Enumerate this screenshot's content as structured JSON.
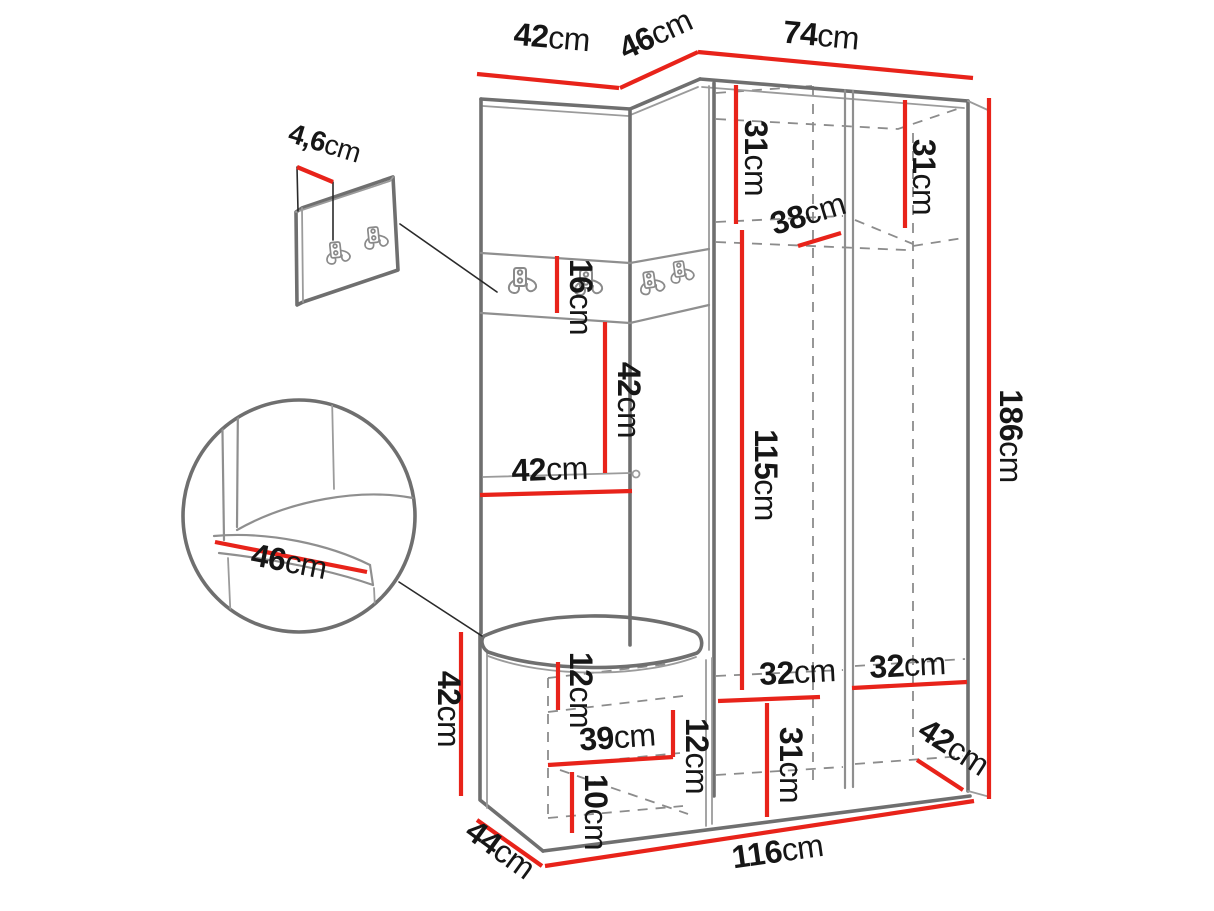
{
  "colors": {
    "dimension_line": "#e8231a",
    "structure_line": "#6f6f6f",
    "dashed_line": "#8c8c8c",
    "label_text": "#161616",
    "background": "#ffffff"
  },
  "dimensions": {
    "top_left_width": {
      "value": "42",
      "unit": "cm"
    },
    "top_corner_width": {
      "value": "46",
      "unit": "cm"
    },
    "top_right_width": {
      "value": "74",
      "unit": "cm"
    },
    "hook_panel_thickness": {
      "value": "4,6",
      "unit": "cm"
    },
    "shelf_left_height": {
      "value": "31",
      "unit": "cm"
    },
    "shelf_right_height": {
      "value": "31",
      "unit": "cm"
    },
    "shelf_depth": {
      "value": "38",
      "unit": "cm"
    },
    "hook_strip_height": {
      "value": "16",
      "unit": "cm"
    },
    "backrest_height": {
      "value": "42",
      "unit": "cm"
    },
    "backrest_width": {
      "value": "42",
      "unit": "cm"
    },
    "wardrobe_inner_height": {
      "value": "115",
      "unit": "cm"
    },
    "total_height": {
      "value": "186",
      "unit": "cm"
    },
    "seat_depth_detail": {
      "value": "46",
      "unit": "cm"
    },
    "bench_height": {
      "value": "42",
      "unit": "cm"
    },
    "bench_top_inset": {
      "value": "12",
      "unit": "cm"
    },
    "bench_shelf_width": {
      "value": "39",
      "unit": "cm"
    },
    "bench_shelf_height": {
      "value": "12",
      "unit": "cm"
    },
    "bench_plinth_height": {
      "value": "10",
      "unit": "cm"
    },
    "bottom_left_width": {
      "value": "32",
      "unit": "cm"
    },
    "bottom_right_width": {
      "value": "32",
      "unit": "cm"
    },
    "bottom_shelf_height": {
      "value": "31",
      "unit": "cm"
    },
    "wardrobe_depth": {
      "value": "42",
      "unit": "cm"
    },
    "bench_depth": {
      "value": "44",
      "unit": "cm"
    },
    "total_width": {
      "value": "116",
      "unit": "cm"
    }
  }
}
